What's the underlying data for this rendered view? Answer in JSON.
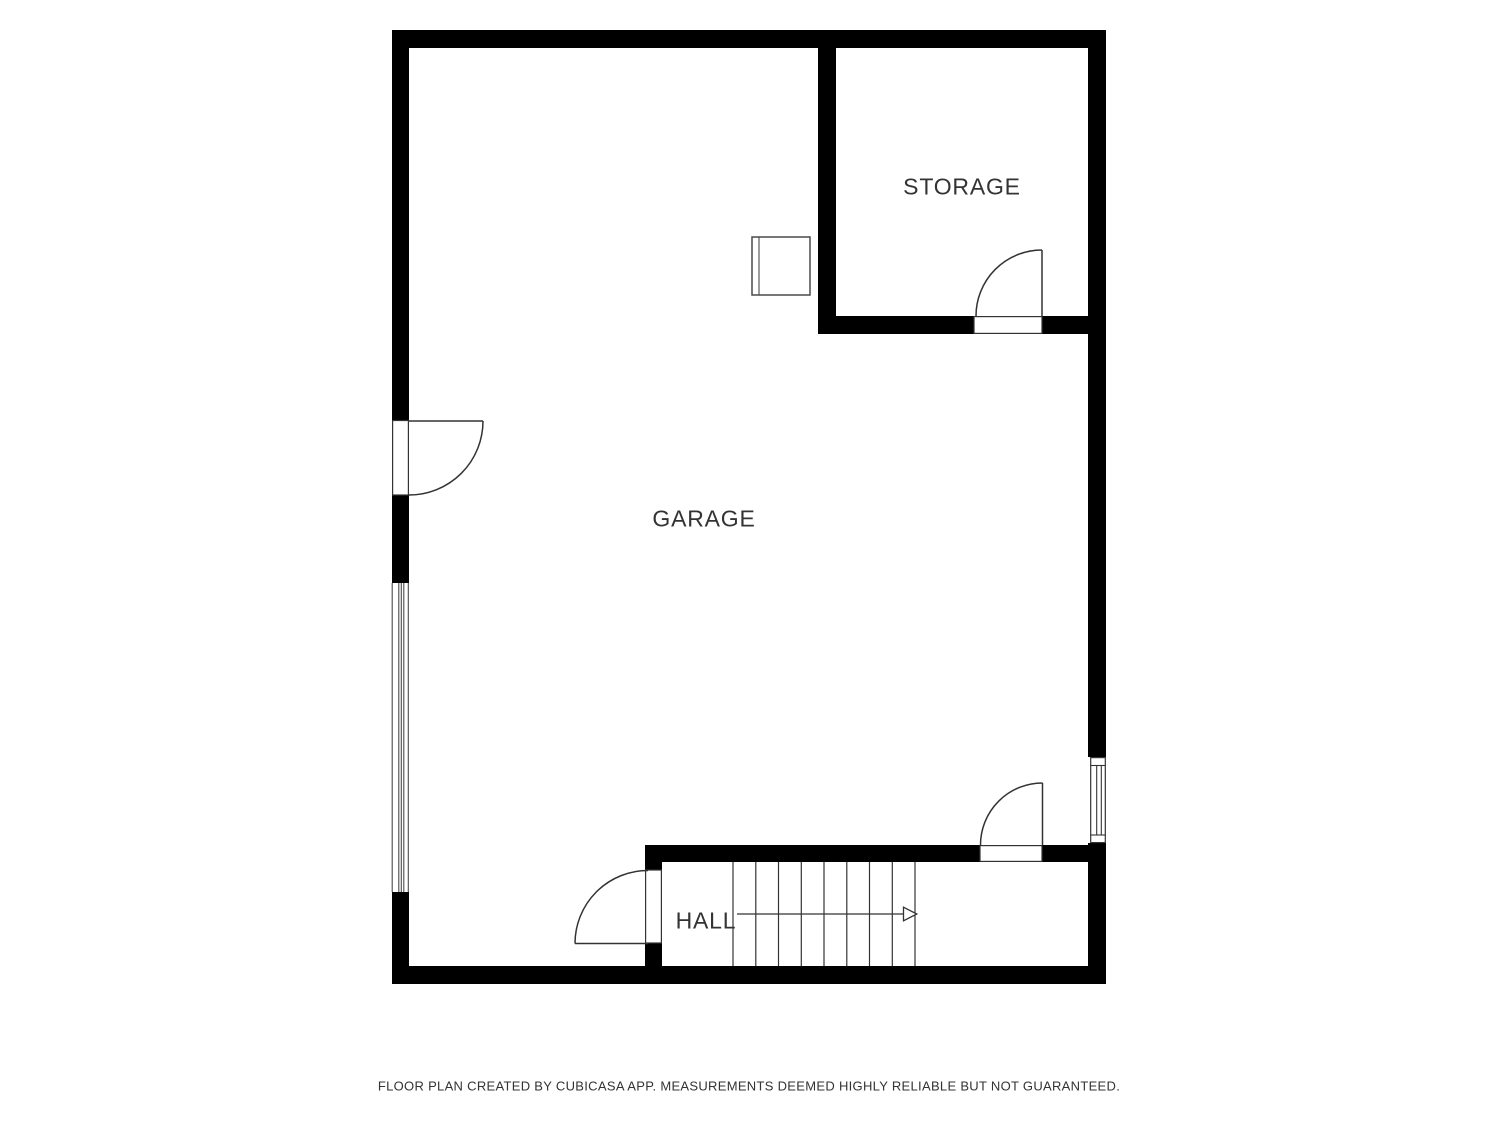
{
  "plan": {
    "rooms": {
      "garage": {
        "label": "GARAGE"
      },
      "storage": {
        "label": "STORAGE"
      },
      "hall": {
        "label": "HALL"
      }
    },
    "stairs": {
      "treads": 8,
      "direction": "right"
    },
    "doors": 4,
    "windows": 1
  },
  "colors": {
    "wall": "#000000",
    "line": "#333333",
    "thin": "#4a4a4a",
    "bg": "#ffffff",
    "text": "#333333"
  },
  "footer": {
    "disclaimer": "FLOOR PLAN CREATED BY CUBICASA APP. MEASUREMENTS DEEMED HIGHLY RELIABLE BUT NOT GUARANTEED."
  }
}
